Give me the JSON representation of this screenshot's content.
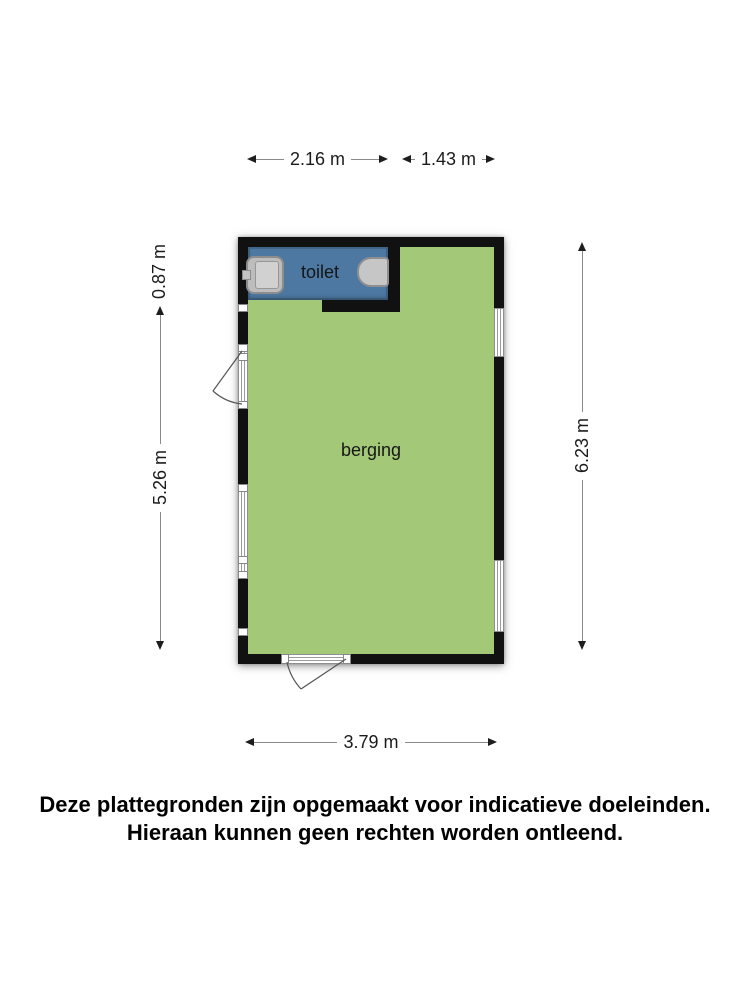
{
  "floorplan": {
    "rooms": [
      {
        "label": "toilet"
      },
      {
        "label": "berging"
      }
    ],
    "fixtures": [
      "sink-icon",
      "faucet-icon",
      "toilet-bowl-icon"
    ],
    "openings": [
      "door-left",
      "window-left",
      "window-right-upper",
      "window-right-lower",
      "door-bottom"
    ]
  },
  "dimensions": {
    "top_left": "2.16 m",
    "top_right": "1.43 m",
    "left_upper": "0.87 m",
    "left_lower": "5.26 m",
    "right_side": "6.23 m",
    "bottom": "3.79 m"
  },
  "disclaimer": {
    "line1": "Deze plattegronden zijn opgemaakt voor indicatieve doeleinden.",
    "line2": "Hieraan kunnen geen rechten worden ontleend."
  },
  "colors": {
    "room_fill_green": "#a3c877",
    "toilet_fill_blue": "#4d78a1",
    "wall": "#111111",
    "fixture_gray": "#c6c6c6",
    "dim_line_gray": "#8a8a8a"
  }
}
